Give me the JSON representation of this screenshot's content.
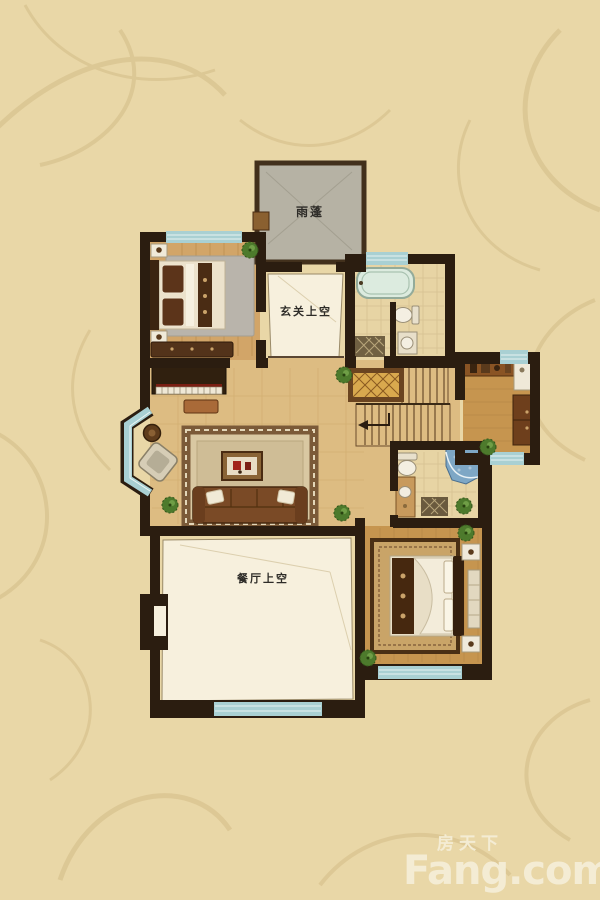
{
  "page": {
    "type": "apartment-floor-plan-upper-level"
  },
  "labels": {
    "canopy": "雨蓬",
    "foyer_void": "玄关上空",
    "dining_void": "餐厅上空"
  },
  "watermark": {
    "site_cn": "房天下",
    "site_en": "Fang.com"
  },
  "colors": {
    "wallpaper": "#e9d7a7",
    "wallpaper_pattern": "#d3bc87",
    "wall": "#2b1d10",
    "window": "#a9d0d3",
    "floor_hall": "#ddbc82",
    "floor_wood_light": "#d2a568",
    "floor_wood_dark": "#c6954f",
    "bath_tile": "#e7d4a4",
    "void": "#f7f0dd",
    "canopy": "#b6b2a4",
    "rug_living": "#d9c8a2",
    "rug_gray": "#b9b4ab",
    "rug_ornate": "#c9a468",
    "shower": "#7ea7c5",
    "plant": "#4d7a2c",
    "sofa": "#7a4a26",
    "watermark": "#f5eed7",
    "label_text": "#2e2c28"
  }
}
